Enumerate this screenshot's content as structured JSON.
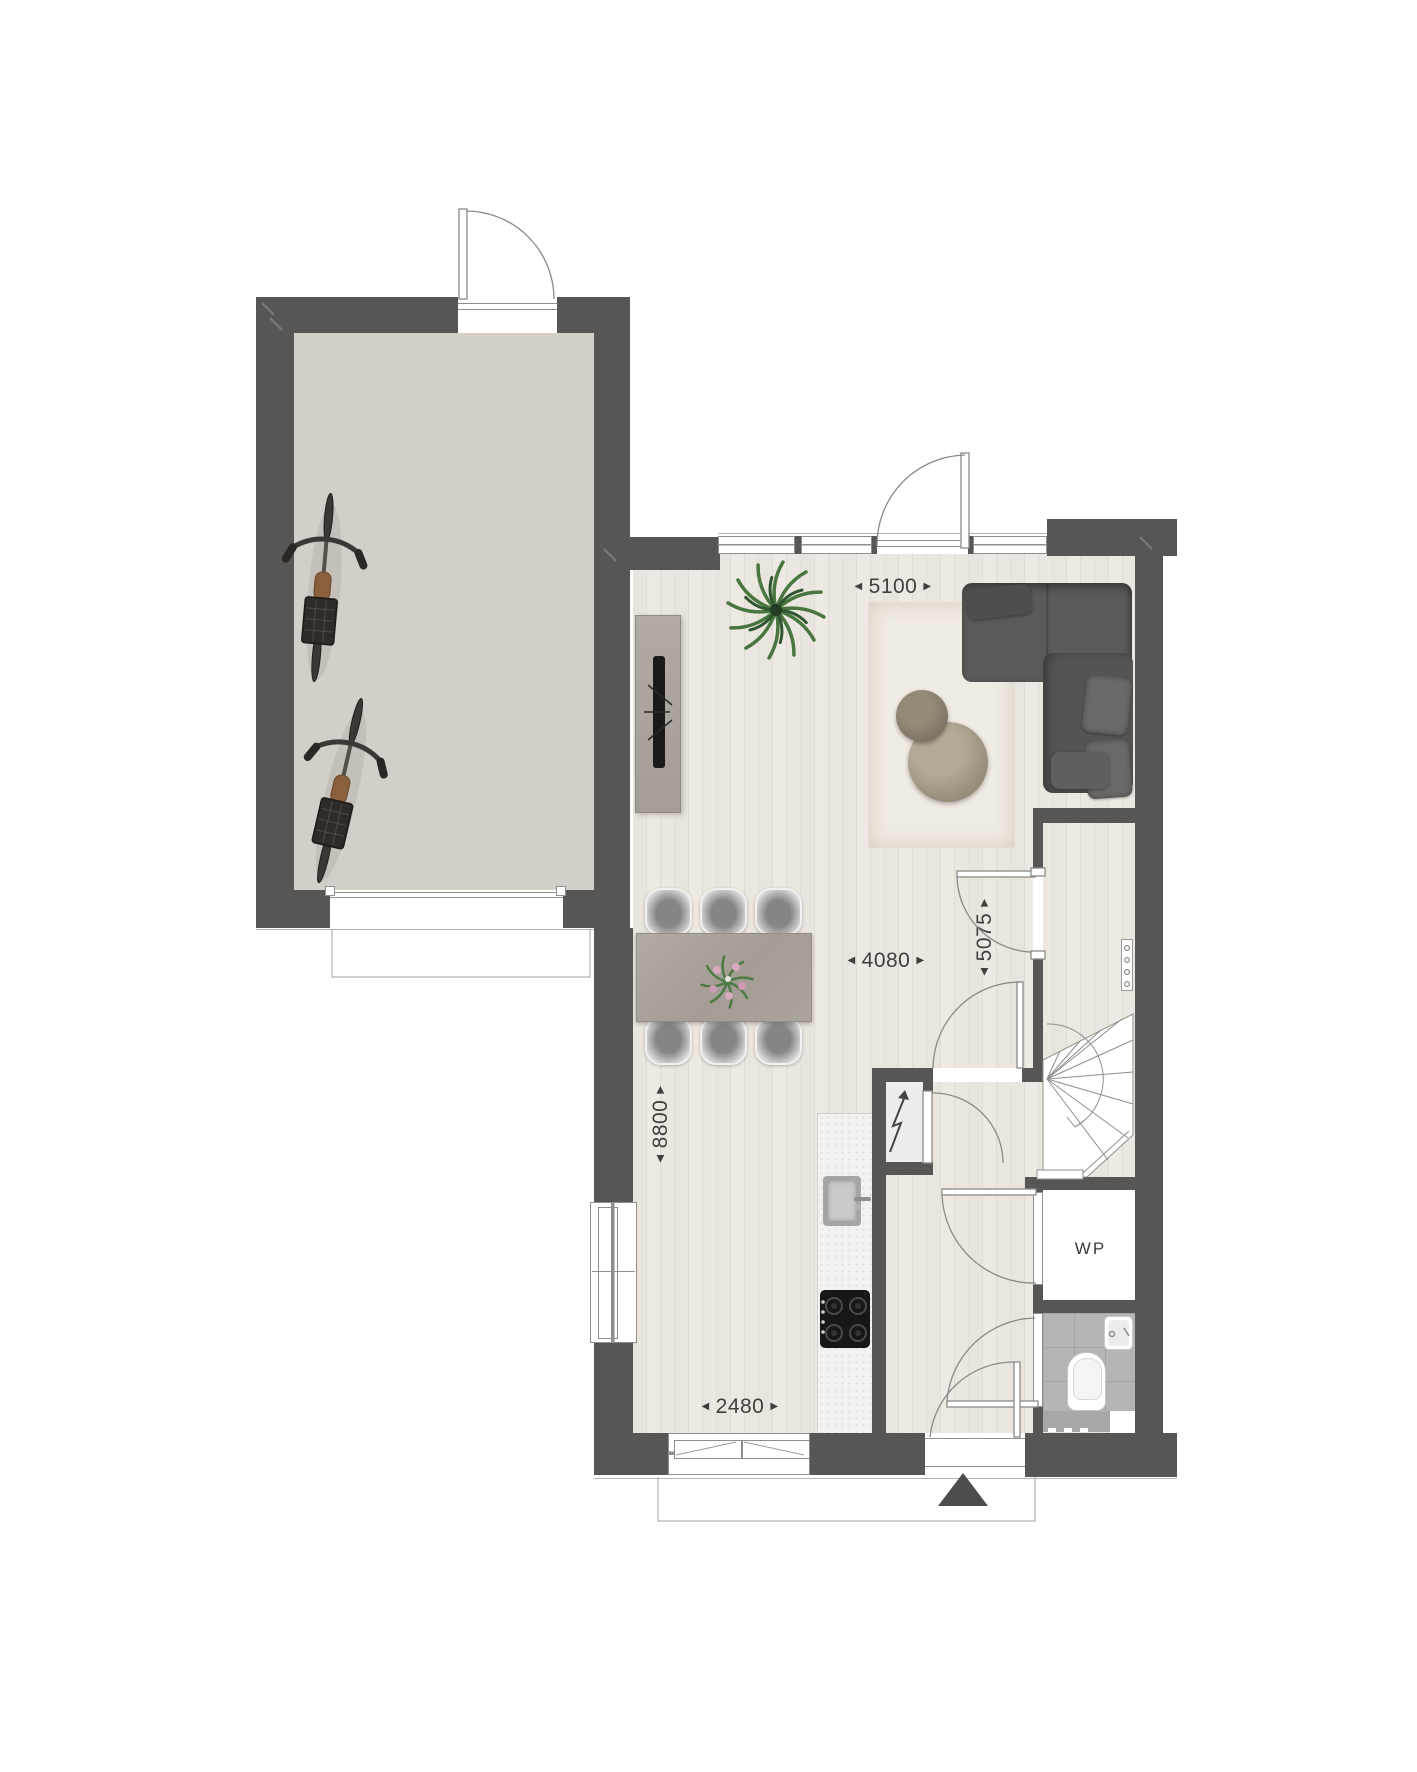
{
  "labels": {
    "heat_pump": "WP"
  },
  "dimensions": {
    "living_top_width": {
      "value": "5100",
      "orientation": "horizontal"
    },
    "living_mid_width": {
      "value": "4080",
      "orientation": "horizontal"
    },
    "hall_depth": {
      "value": "5075",
      "orientation": "vertical"
    },
    "house_depth": {
      "value": "8800",
      "orientation": "vertical"
    },
    "kitchen_width": {
      "value": "2480",
      "orientation": "horizontal"
    }
  },
  "icons": {
    "arrow_left": "◀",
    "arrow_right": "▶",
    "north_arrow": "black triangle pointing up",
    "lightning_bolt": "electrical meter cupboard symbol",
    "plant": "potted palm plant",
    "bike": "bicycle top view",
    "toilet": "toilet top view",
    "washbasin": "small corner basin",
    "sink": "kitchen sink",
    "cooktop": "4-burner hob",
    "stair": "winder staircase with walking line"
  },
  "colors": {
    "wall": "#575655",
    "line": "#8f8f8d",
    "thin": "#b5b3b0",
    "dim": "#403f3d",
    "garage_floor": "#d3cfc8",
    "rug": "#f0ebe3",
    "sofa": "#5b5a58",
    "sofa_dark": "#504e4c",
    "pillow": "#6b6967",
    "table": "#a8a29a",
    "bench": "#aaa49c",
    "counter": "#f3f2f0",
    "tile": "#b6b5b4",
    "tile_line": "#a5a4a3",
    "north": "#4e4d4b"
  }
}
